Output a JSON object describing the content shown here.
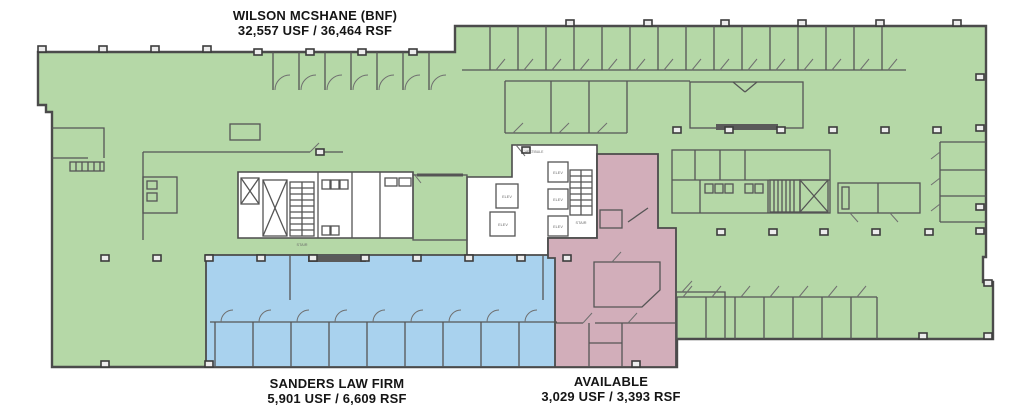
{
  "plan": {
    "background": "#ffffff",
    "wall_color": "#4b4b4b",
    "tenants": [
      {
        "name": "WILSON MCSHANE (BNF)",
        "area": "32,557 USF / 36,464 RSF",
        "color": "#b5d8a7"
      },
      {
        "name": "SANDERS LAW FIRM",
        "area": "5,901 USF / 6,609 RSF",
        "color": "#a9d2ee"
      },
      {
        "name": "AVAILABLE",
        "area": "3,029 USF / 3,393 RSF",
        "color": "#d2aeba"
      }
    ],
    "core_labels": {
      "elev": "ELEV",
      "stair": "STAIR",
      "vestibule": "VESTIBULE"
    }
  }
}
